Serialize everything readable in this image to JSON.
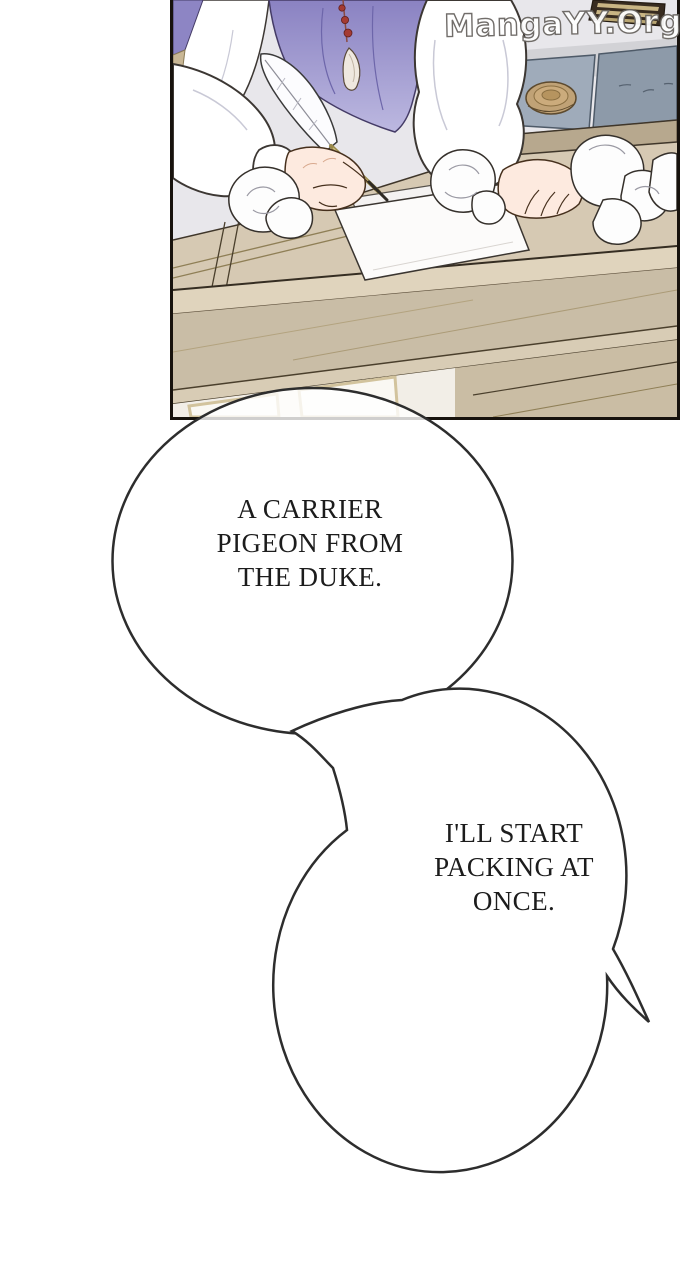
{
  "watermark": {
    "text": "MangaYY.Org"
  },
  "panel": {
    "colors": {
      "wall": "#e8e7eb",
      "shelf": "#382c20",
      "cushion_light": "#9fabba",
      "cushion_dark": "#8d9aa9",
      "platform": "#b7a88e",
      "basket": "#c0a276",
      "desk": "#d6c9b3",
      "desk_edge": "#e0d4bd",
      "desk_apron": "#c9bda6",
      "vest": "#9b93cc",
      "shirt": "#ffffff",
      "skin": "#fdeadf",
      "paper": "#fcfbfa",
      "outline": "#35302b"
    }
  },
  "bubbles": [
    {
      "lines": [
        "A CARRIER",
        "PIGEON FROM",
        "THE DUKE."
      ]
    },
    {
      "lines": [
        "I'LL START",
        "PACKING AT",
        "ONCE."
      ]
    }
  ]
}
